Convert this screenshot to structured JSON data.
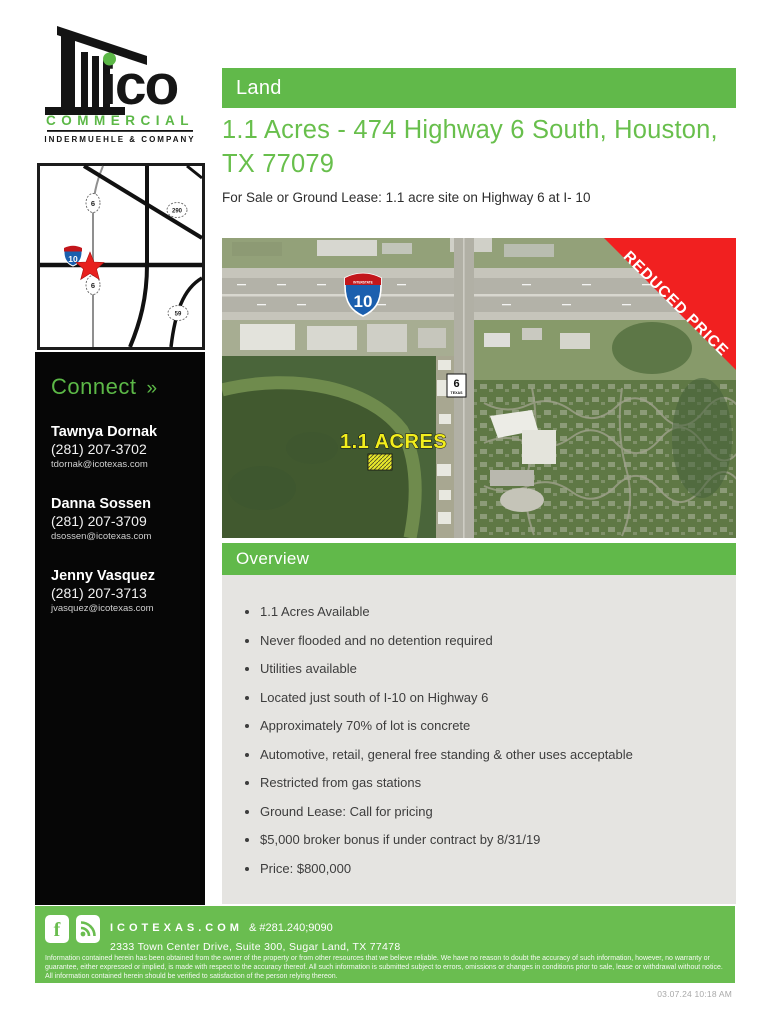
{
  "colors": {
    "green": "#61b94a",
    "title_green": "#68bf4c",
    "footer_green": "#6abd50",
    "ribbon_red": "#f12020",
    "body_gray": "#e5e4e1",
    "sidebar_black": "#060606"
  },
  "logo": {
    "name": "ico",
    "word": "COMMERCIAL",
    "tagline": "INDERMUEHLE & COMPANY"
  },
  "header": {
    "category": "Land",
    "title": "1.1 Acres - 474 Highway 6 South, Houston, TX 77079",
    "subtitle": "For Sale or Ground Lease: 1.1 acre site on Highway 6 at I- 10"
  },
  "mini_map": {
    "interstate": "10",
    "routes": {
      "top": "6",
      "ne": "290",
      "below_star": "6",
      "se": "59"
    }
  },
  "connect": {
    "heading": "Connect",
    "arrow": "»",
    "contacts": [
      {
        "name": "Tawnya Dornak",
        "phone": "(281) 207-3702",
        "email": "tdornak@icotexas.com"
      },
      {
        "name": "Danna Sossen",
        "phone": "(281) 207-3709",
        "email": "dsossen@icotexas.com"
      },
      {
        "name": "Jenny Vasquez",
        "phone": "(281) 207-3713",
        "email": "jvasquez@icotexas.com"
      }
    ]
  },
  "aerial": {
    "ribbon": "REDUCED PRICE",
    "interstate_label": "INTERSTATE",
    "interstate": "10",
    "route": "6",
    "route_state": "TEXAS",
    "acres_label": "1.1 ACRES"
  },
  "overview": {
    "heading": "Overview",
    "bullets": [
      "1.1 Acres Available",
      "Never flooded and no detention required",
      "Utilities available",
      "Located just south of I-10 on Highway 6",
      "Approximately 70% of lot is concrete",
      "Automotive, retail, general free standing & other uses acceptable",
      "Restricted from gas stations",
      "Ground Lease: Call for pricing",
      "$5,000 broker bonus if under contract by 8/31/19",
      "Price: $800,000"
    ]
  },
  "footer": {
    "website": "ICOTEXAS.COM",
    "phone": "& #281.240;9090",
    "address": "2333 Town Center Drive, Suite 300, Sugar Land, TX 77478",
    "disclaimer": "Information contained herein has been obtained from the owner of the property or from other resources that we believe reliable. We have no reason to doubt the accuracy of such information, however, no warranty or guarantee, either expressed or implied, is made with respect to the accuracy thereof. All such information is submitted subject to errors, omissions or changes in conditions prior to sale, lease or withdrawal without notice. All information contained herein should be verified to satisfaction of the person relying thereon.",
    "timestamp": "03.07.24 10:18 AM"
  }
}
